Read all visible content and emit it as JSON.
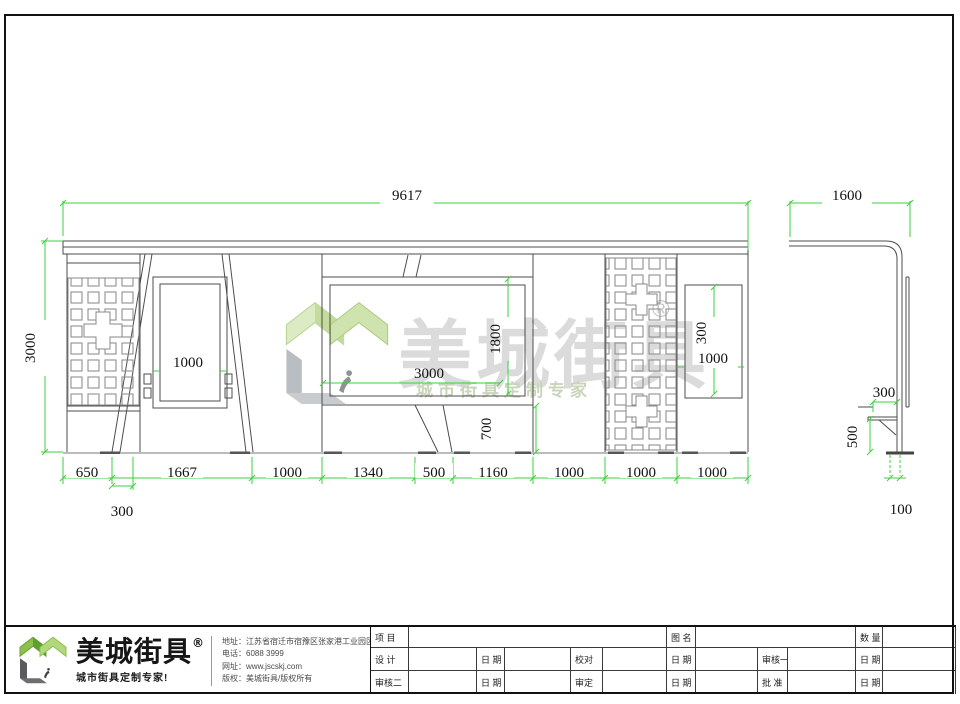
{
  "watermark": {
    "brand": "美城街具",
    "reg": "®",
    "tagline": "城市街具定制专家 ！"
  },
  "drawing": {
    "dims": {
      "overall_width": "9617",
      "side_width": "1600",
      "overall_height": "3000",
      "lightbox_width": "1000",
      "ad_width": "3000",
      "ad_height": "1800",
      "support_height": "700",
      "right_box_height": "300",
      "right_box_width": "1000",
      "bottom": [
        "650",
        "1667",
        "1000",
        "1340",
        "500",
        "1160",
        "1000",
        "1000",
        "1000"
      ],
      "left_offset": "300",
      "seat_depth": "300",
      "seat_height": "500",
      "post_width": "100"
    }
  },
  "footer": {
    "brand": "美城街具",
    "reg": "®",
    "tagline": "城市街具定制专家!",
    "contact": [
      {
        "label": "地址：",
        "value": "江苏省宿迁市宿豫区张家港工业园区保丰路西侧1号"
      },
      {
        "label": "电话：",
        "value": "6088 3999"
      },
      {
        "label": "网址：",
        "value": "www.jscskj.com"
      },
      {
        "label": "版权：",
        "value": "美城街具/版权所有"
      }
    ]
  },
  "titleblock": {
    "project": "项 目",
    "drawing_name": "图 名",
    "quantity": "数 量",
    "design": "设 计",
    "proofread": "校对",
    "review1": "审核一",
    "review2": "审核二",
    "approve": "审定",
    "ratify": "批 准",
    "date": "日 期"
  }
}
